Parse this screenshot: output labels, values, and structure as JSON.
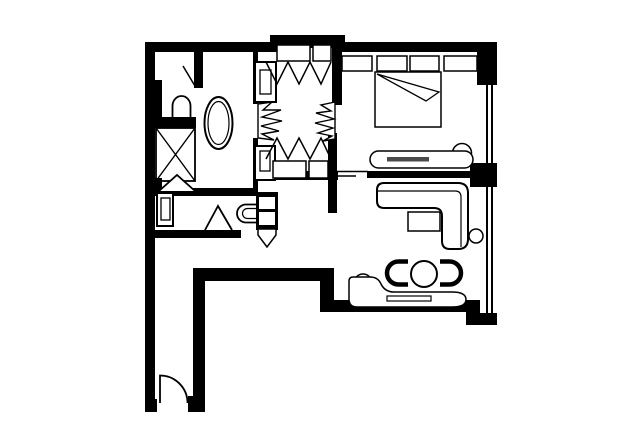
{
  "canvas": {
    "width": 640,
    "height": 446,
    "background": "#ffffff",
    "ink": "#000000",
    "accent_gray": "#4a4a4a"
  },
  "floor_plan": {
    "description": "hotel-suite-floor-plan",
    "layers": [
      {
        "name": "walls",
        "defaults": {
          "fill": "#000000",
          "sw": 0
        },
        "shapes": [
          {
            "name": "top-wall-left",
            "kind": "rect",
            "x": 145,
            "y": 42,
            "w": 137,
            "h": 10
          },
          {
            "name": "top-closet-bump-wall",
            "kind": "rect",
            "x": 270,
            "y": 35,
            "w": 75,
            "h": 13
          },
          {
            "name": "top-wall-right",
            "kind": "rect",
            "x": 336,
            "y": 42,
            "w": 148,
            "h": 10
          },
          {
            "name": "top-right-corner-wall",
            "kind": "rect",
            "x": 477,
            "y": 42,
            "w": 20,
            "h": 43
          },
          {
            "name": "left-outer-wall",
            "kind": "rect",
            "x": 145,
            "y": 42,
            "w": 10,
            "h": 369
          },
          {
            "name": "toilet-alcove-side-wall",
            "kind": "rect",
            "x": 145,
            "y": 80,
            "w": 17,
            "h": 48
          },
          {
            "name": "toilet-alcove-bottom-wall",
            "kind": "rect",
            "x": 156,
            "y": 117,
            "w": 40,
            "h": 11
          },
          {
            "name": "toilet-alcove-divider-wall",
            "kind": "rect",
            "x": 194,
            "y": 52,
            "w": 9,
            "h": 36
          },
          {
            "name": "shower-corner-wall",
            "kind": "rect",
            "x": 145,
            "y": 178,
            "w": 17,
            "h": 18
          },
          {
            "name": "hallway-top-wall",
            "kind": "rect",
            "x": 150,
            "y": 188,
            "w": 108,
            "h": 8
          },
          {
            "name": "hallway-bottom-wall",
            "kind": "rect",
            "x": 153,
            "y": 230,
            "w": 88,
            "h": 8
          },
          {
            "name": "bath-vestibule-wall-upper",
            "kind": "rect",
            "x": 253,
            "y": 52,
            "w": 5,
            "h": 52
          },
          {
            "name": "bath-vestibule-wall-lower",
            "kind": "rect",
            "x": 253,
            "y": 138,
            "w": 5,
            "h": 50
          },
          {
            "name": "vestibule-bedroom-wall-upper",
            "kind": "rect",
            "x": 332,
            "y": 42,
            "w": 10,
            "h": 63
          },
          {
            "name": "vestibule-living-wall-lower",
            "kind": "rect",
            "x": 328,
            "y": 133,
            "w": 9,
            "h": 80
          },
          {
            "name": "closet-bottom-wall",
            "kind": "rect",
            "x": 275,
            "y": 171,
            "w": 63,
            "h": 9
          },
          {
            "name": "bedroom-living-divider-wall",
            "kind": "rect",
            "x": 367,
            "y": 171,
            "w": 111,
            "h": 7
          },
          {
            "name": "window-pier-wall",
            "kind": "rect",
            "x": 470,
            "y": 163,
            "w": 27,
            "h": 24
          },
          {
            "name": "passage-wall-horizontal",
            "kind": "rect",
            "x": 193,
            "y": 268,
            "w": 141,
            "h": 13
          },
          {
            "name": "passage-wall-connector",
            "kind": "rect",
            "x": 320,
            "y": 268,
            "w": 14,
            "h": 44
          },
          {
            "name": "living-bottom-wall",
            "kind": "rect",
            "x": 320,
            "y": 300,
            "w": 150,
            "h": 12
          },
          {
            "name": "bottom-right-corner-wall-v",
            "kind": "rect",
            "x": 466,
            "y": 300,
            "w": 14,
            "h": 25
          },
          {
            "name": "bottom-right-corner-wall-h",
            "kind": "rect",
            "x": 466,
            "y": 313,
            "w": 31,
            "h": 12
          },
          {
            "name": "corridor-right-wall",
            "kind": "rect",
            "x": 193,
            "y": 268,
            "w": 12,
            "h": 137
          },
          {
            "name": "corridor-right-entry-stub",
            "kind": "rect",
            "x": 188,
            "y": 396,
            "w": 17,
            "h": 16
          },
          {
            "name": "corridor-left-entry-stub",
            "kind": "rect",
            "x": 145,
            "y": 399,
            "w": 12,
            "h": 13
          }
        ]
      },
      {
        "name": "windows",
        "defaults": {
          "fill": "#000000",
          "sw": 0
        },
        "shapes": [
          {
            "name": "bedroom-window-glazing-outer",
            "kind": "rect",
            "x": 486,
            "y": 84,
            "w": 2,
            "h": 79
          },
          {
            "name": "bedroom-window-glazing-inner",
            "kind": "rect",
            "x": 491,
            "y": 84,
            "w": 2,
            "h": 79
          },
          {
            "name": "living-window-glazing-outer",
            "kind": "rect",
            "x": 486,
            "y": 187,
            "w": 2,
            "h": 126
          },
          {
            "name": "living-window-glazing-inner",
            "kind": "rect",
            "x": 491,
            "y": 187,
            "w": 2,
            "h": 126
          }
        ]
      },
      {
        "name": "partition-lines",
        "defaults": {
          "sw": 1.6
        },
        "shapes": [
          {
            "name": "divider-ledge-line-upper",
            "kind": "line",
            "x1": 337,
            "y1": 171.5,
            "x2": 368,
            "y2": 171.5
          },
          {
            "name": "divider-ledge-line-lower",
            "kind": "line",
            "x1": 337,
            "y1": 176,
            "x2": 356,
            "y2": 176
          }
        ]
      },
      {
        "name": "bathroom",
        "defaults": {
          "sw": 1.6
        },
        "shapes": [
          {
            "name": "bathtub-outer-rim",
            "kind": "ellipse",
            "cx": 218.5,
            "cy": 123,
            "rx": 14,
            "ry": 26,
            "sw": 2
          },
          {
            "name": "bathtub-inner-rim",
            "kind": "ellipse",
            "cx": 218.5,
            "cy": 123,
            "rx": 10.5,
            "ry": 21.5,
            "sw": 1.2
          },
          {
            "name": "alcove-toilet",
            "kind": "path",
            "d": "M 172.5,121 V 106 A 9,10 0 0 1 190.5,106 V 121",
            "sw": 1.8
          },
          {
            "name": "alcove-door-leaf",
            "kind": "line",
            "x1": 195,
            "y1": 86,
            "x2": 183,
            "y2": 66,
            "sw": 1.5
          },
          {
            "name": "shower-stall",
            "kind": "rect",
            "x": 156,
            "y": 128,
            "w": 39,
            "h": 53,
            "sw": 1.8
          },
          {
            "name": "shower-x-diagonal-1",
            "kind": "line",
            "x1": 156,
            "y1": 128,
            "x2": 195,
            "y2": 181,
            "sw": 1.4
          },
          {
            "name": "shower-x-diagonal-2",
            "kind": "line",
            "x1": 195,
            "y1": 128,
            "x2": 156,
            "y2": 181,
            "sw": 1.4
          },
          {
            "name": "shower-door-swing",
            "kind": "polyline",
            "points": "159,191 177,175 195,191",
            "fill": "#ffffff",
            "sw": 1.8
          },
          {
            "name": "wall-cabinet-upper",
            "kind": "rect",
            "x": 255,
            "y": 62,
            "w": 21,
            "h": 40,
            "fill": "#ffffff",
            "sw": 2
          },
          {
            "name": "wall-cabinet-upper-inner",
            "kind": "rect",
            "x": 260,
            "y": 70,
            "w": 11,
            "h": 24,
            "sw": 1.3
          },
          {
            "name": "wall-cabinet-lower",
            "kind": "rect",
            "x": 255,
            "y": 146,
            "w": 20,
            "h": 34,
            "fill": "#ffffff",
            "sw": 2
          },
          {
            "name": "wall-cabinet-lower-inner",
            "kind": "rect",
            "x": 260,
            "y": 151,
            "w": 10,
            "h": 20,
            "sw": 1.3
          }
        ]
      },
      {
        "name": "dressing-closets",
        "defaults": {
          "sw": 1.5
        },
        "shapes": [
          {
            "name": "closet-top-shelf-left",
            "kind": "rect",
            "x": 277,
            "y": 45,
            "w": 33,
            "h": 16,
            "fill": "#ffffff",
            "sw": 1.5
          },
          {
            "name": "closet-top-shelf-right",
            "kind": "rect",
            "x": 313,
            "y": 45,
            "w": 18,
            "h": 16,
            "fill": "#ffffff",
            "sw": 1.5
          },
          {
            "name": "closet-top-hanging-zigzag",
            "kind": "polyline",
            "points": "266,62 277,84 288,62 299,84 310,62 321,84 331,62"
          },
          {
            "name": "folding-door-left",
            "kind": "polygon",
            "points": "258,104 272,102 263,110 281,110 262,117 282,121 261,126 279,131 262,134 274,140 258,138",
            "fill": "#ffffff",
            "sw": 1.4
          },
          {
            "name": "folding-door-right",
            "kind": "polygon",
            "points": "335,102 321,105 331,111 316,113 334,119 315,123 333,128 318,133 332,136 323,141 335,139",
            "fill": "#ffffff",
            "sw": 1.4
          },
          {
            "name": "closet-bottom-hanging-zigzag",
            "kind": "polyline",
            "points": "266,159 277,138 288,159 299,138 310,159 321,138 331,159"
          },
          {
            "name": "closet-bottom-shelf-left",
            "kind": "rect",
            "x": 273,
            "y": 161,
            "w": 33,
            "h": 17,
            "fill": "#ffffff",
            "sw": 1.5
          },
          {
            "name": "closet-bottom-shelf-right",
            "kind": "rect",
            "x": 309,
            "y": 161,
            "w": 19,
            "h": 17,
            "fill": "#ffffff",
            "sw": 1.5
          }
        ]
      },
      {
        "name": "bedroom",
        "defaults": {
          "sw": 1.5
        },
        "shapes": [
          {
            "name": "nightstand-left",
            "kind": "rect",
            "x": 342,
            "y": 56,
            "w": 30,
            "h": 15
          },
          {
            "name": "bed-pillow-left",
            "kind": "rect",
            "x": 377,
            "y": 56,
            "w": 30,
            "h": 15
          },
          {
            "name": "bed-pillow-right",
            "kind": "rect",
            "x": 410,
            "y": 56,
            "w": 29,
            "h": 15
          },
          {
            "name": "nightstand-right",
            "kind": "rect",
            "x": 444,
            "y": 56,
            "w": 33,
            "h": 15
          },
          {
            "name": "bed",
            "kind": "rect",
            "x": 375,
            "y": 72,
            "w": 66,
            "h": 55,
            "fill": "#ffffff"
          },
          {
            "name": "bed-sheet-fold",
            "kind": "polygon",
            "points": "377,74 439,92 426,101",
            "fill": "#ffffff",
            "sw": 1.3
          },
          {
            "name": "chaise-bolster",
            "kind": "circle",
            "cx": 462,
            "cy": 153,
            "r": 9.5,
            "fill": "#ffffff"
          },
          {
            "name": "chaise-bench",
            "kind": "rect",
            "x": 370,
            "y": 151,
            "w": 103,
            "h": 17,
            "rx": 8.5,
            "fill": "#ffffff"
          },
          {
            "name": "chaise-cushion-stripe",
            "kind": "rect",
            "x": 387,
            "y": 157,
            "w": 42,
            "h": 4.5,
            "fill": "#4a4a4a",
            "sw": 0
          }
        ]
      },
      {
        "name": "living-room",
        "defaults": {
          "sw": 1.5
        },
        "shapes": [
          {
            "name": "sectional-sofa",
            "kind": "path",
            "d": "M 384,183 H 458 Q 468,183 468,193 V 239 Q 468,249 458,249 H 450 Q 442,249 442,241 V 216 Q 442,208 434,208 H 384 Q 377,208 377,201 V 190 Q 377,183 384,183 Z",
            "fill": "#ffffff",
            "sw": 2
          },
          {
            "name": "sectional-sofa-back-line",
            "kind": "path",
            "d": "M 378,191 H 455 Q 461,191 461,197 V 247",
            "sw": 1.2
          },
          {
            "name": "coffee-table",
            "kind": "rect",
            "x": 408,
            "y": 212,
            "w": 32,
            "h": 19,
            "fill": "#ffffff"
          },
          {
            "name": "side-table",
            "kind": "circle",
            "cx": 476,
            "cy": 236,
            "r": 7,
            "fill": "#ffffff"
          },
          {
            "name": "dining-table",
            "kind": "circle",
            "cx": 424,
            "cy": 274,
            "r": 13,
            "fill": "#ffffff",
            "sw": 2
          },
          {
            "name": "tub-chair-left",
            "kind": "path",
            "d": "M 408,261.5 H 398.5 A 11.5,11.5 0 0 0 398.5,284.5 H 408",
            "sw": 4.5
          },
          {
            "name": "tub-chair-right",
            "kind": "path",
            "d": "M 440,261.5 H 449.5 A 11.5,11.5 0 0 1 449.5,284.5 H 440",
            "sw": 4.5
          },
          {
            "name": "daybed-bolster",
            "kind": "circle",
            "cx": 363,
            "cy": 283,
            "r": 9,
            "fill": "#ffffff"
          },
          {
            "name": "daybed-lounge",
            "kind": "path",
            "d": "M 353,277 H 370 Q 378,277 381,284 Q 385,292 394,292 H 452 Q 466,292 466,299.5 Q 466,307 452,307 H 357 Q 349,307 349,299 V 281 Q 349,277 353,277 Z",
            "fill": "#ffffff"
          },
          {
            "name": "daybed-cushion-stripe",
            "kind": "rect",
            "x": 387,
            "y": 296,
            "w": 44,
            "h": 5,
            "fill": "#ffffff",
            "sw": 1.2
          }
        ]
      },
      {
        "name": "hallway-wc",
        "defaults": {
          "sw": 1.6
        },
        "shapes": [
          {
            "name": "hall-cabinet",
            "kind": "rect",
            "x": 157,
            "y": 193,
            "w": 16,
            "h": 33,
            "fill": "#ffffff",
            "sw": 2
          },
          {
            "name": "hall-cabinet-inner",
            "kind": "rect",
            "x": 161,
            "y": 198,
            "w": 9,
            "h": 22,
            "sw": 1.3
          },
          {
            "name": "hall-door-swing",
            "kind": "polyline",
            "points": "205,230 218,206 232,230",
            "fill": "#ffffff",
            "sw": 1.8
          },
          {
            "name": "wc-toilet-outer",
            "kind": "path",
            "d": "M 257,204.5 H 246 A 9,9 0 0 0 246,222.5 H 257",
            "sw": 1.8
          },
          {
            "name": "wc-toilet-inner",
            "kind": "path",
            "d": "M 257,208.5 H 247.5 A 5,5 0 0 0 247.5,218.5 H 257",
            "sw": 1.2
          },
          {
            "name": "wc-shelf-frame",
            "kind": "rect",
            "x": 256,
            "y": 192,
            "w": 22,
            "h": 38,
            "fill": "#000000",
            "sw": 0
          },
          {
            "name": "wc-shelf-upper",
            "kind": "rect",
            "x": 259,
            "y": 197,
            "w": 16,
            "h": 12,
            "fill": "#ffffff",
            "sw": 0
          },
          {
            "name": "wc-shelf-lower",
            "kind": "rect",
            "x": 259,
            "y": 212,
            "w": 16,
            "h": 13,
            "fill": "#ffffff",
            "sw": 0
          },
          {
            "name": "wc-door-swing",
            "kind": "polygon",
            "points": "258,229 276,229 276,235 267,247 258,235",
            "fill": "#ffffff",
            "sw": 1.5
          }
        ]
      },
      {
        "name": "entry-corridor",
        "defaults": {
          "sw": 1.8
        },
        "shapes": [
          {
            "name": "entry-door-swing",
            "kind": "path",
            "d": "M 160,403 V 375.5 A 27.5,27.5 0 0 1 187.5,403"
          }
        ]
      }
    ]
  }
}
